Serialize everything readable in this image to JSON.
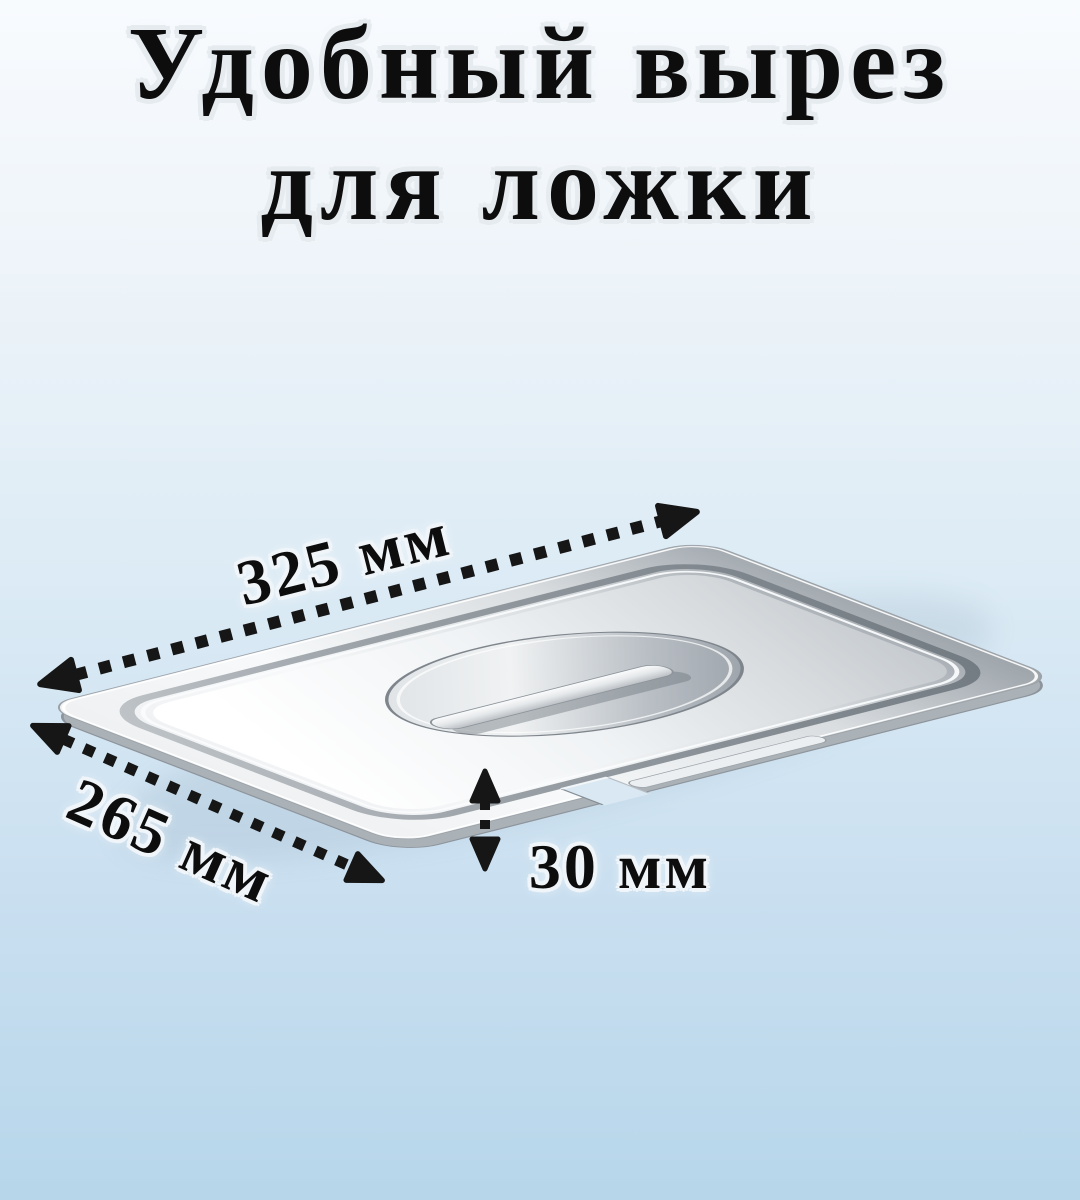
{
  "title": {
    "line1": "Удобный вырез",
    "line2": "для ложки"
  },
  "dimensions": {
    "length": {
      "label": "325 мм",
      "value": 325,
      "unit": "мм"
    },
    "width": {
      "label": "265 мм",
      "value": 265,
      "unit": "мм"
    },
    "notch_height": {
      "label": "30 мм",
      "value": 30,
      "unit": "мм"
    }
  },
  "colors": {
    "background_top": "#f8fbfe",
    "background_bottom": "#b7d6ea",
    "title_color": "#0d0d0d",
    "arrow_color": "#161616",
    "steel_light": "#f6f8f9",
    "steel_dark": "#9fa6ac"
  }
}
